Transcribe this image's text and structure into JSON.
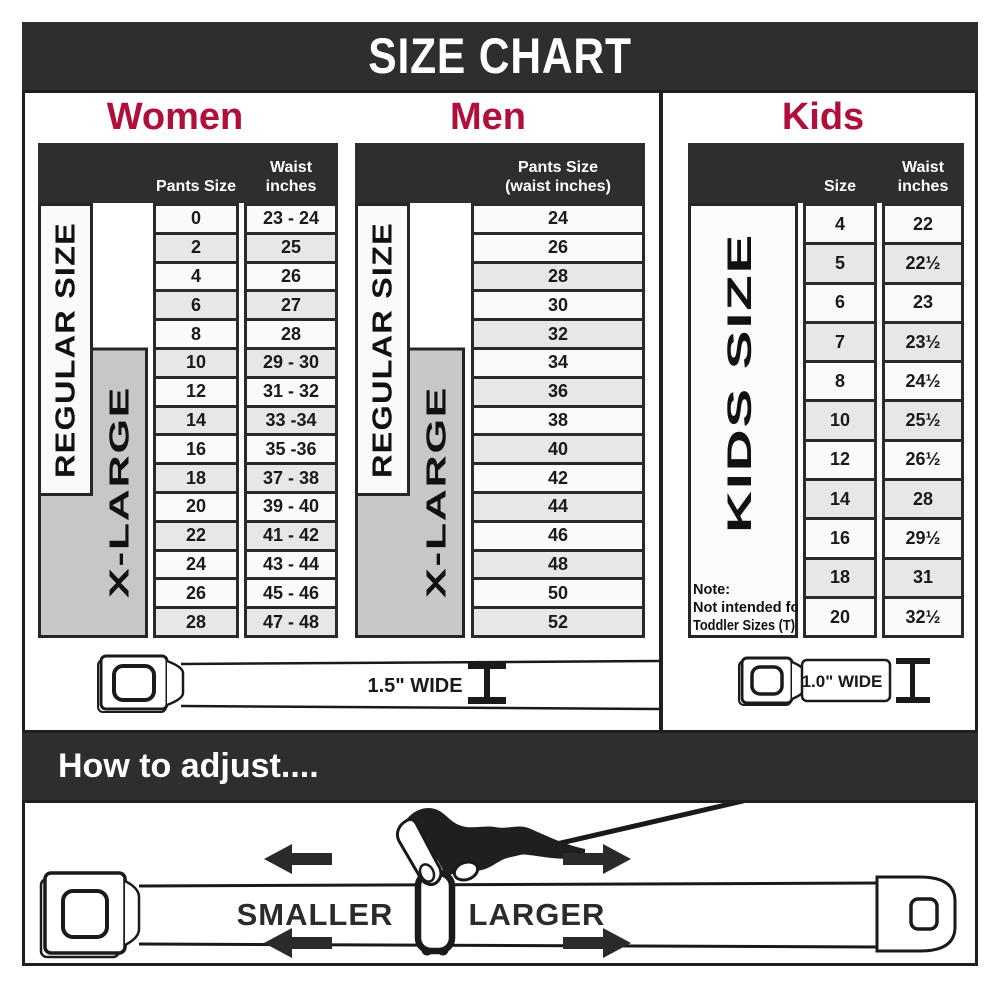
{
  "title": "SIZE CHART",
  "colors": {
    "banner_bg": "#2e2e2e",
    "border": "#1f1f1f",
    "cell_border": "#2a2a2a",
    "heading_red": "#b00f3c",
    "row_light": "#fafafa",
    "row_shade": "#e7e7e7",
    "xl_gray": "#c7c7c7"
  },
  "women": {
    "heading": "Women",
    "col1_header": "Pants Size",
    "col2_header_line1": "Waist",
    "col2_header_line2": "inches",
    "regular_label": "REGULAR SIZE",
    "xlarge_label": "X-LARGE",
    "belt_label": "1.5\" WIDE",
    "rows": [
      {
        "size": "0",
        "waist": "23 - 24",
        "shade": false
      },
      {
        "size": "2",
        "waist": "25",
        "shade": true
      },
      {
        "size": "4",
        "waist": "26",
        "shade": false
      },
      {
        "size": "6",
        "waist": "27",
        "shade": true
      },
      {
        "size": "8",
        "waist": "28",
        "shade": false
      },
      {
        "size": "10",
        "waist": "29 - 30",
        "shade": true
      },
      {
        "size": "12",
        "waist": "31 - 32",
        "shade": false
      },
      {
        "size": "14",
        "waist": "33 -34",
        "shade": true
      },
      {
        "size": "16",
        "waist": "35 -36",
        "shade": false
      },
      {
        "size": "18",
        "waist": "37 - 38",
        "shade": true
      },
      {
        "size": "20",
        "waist": "39 - 40",
        "shade": false
      },
      {
        "size": "22",
        "waist": "41 - 42",
        "shade": true
      },
      {
        "size": "24",
        "waist": "43 - 44",
        "shade": false
      },
      {
        "size": "26",
        "waist": "45 - 46",
        "shade": false
      },
      {
        "size": "28",
        "waist": "47 - 48",
        "shade": true
      }
    ]
  },
  "men": {
    "heading": "Men",
    "col_header_line1": "Pants Size",
    "col_header_line2": "(waist inches)",
    "regular_label": "REGULAR SIZE",
    "xlarge_label": "X-LARGE",
    "rows": [
      {
        "size": "24",
        "shade": false
      },
      {
        "size": "26",
        "shade": false
      },
      {
        "size": "28",
        "shade": true
      },
      {
        "size": "30",
        "shade": false
      },
      {
        "size": "32",
        "shade": true
      },
      {
        "size": "34",
        "shade": false
      },
      {
        "size": "36",
        "shade": true
      },
      {
        "size": "38",
        "shade": false
      },
      {
        "size": "40",
        "shade": true
      },
      {
        "size": "42",
        "shade": false
      },
      {
        "size": "44",
        "shade": true
      },
      {
        "size": "46",
        "shade": false
      },
      {
        "size": "48",
        "shade": true
      },
      {
        "size": "50",
        "shade": false
      },
      {
        "size": "52",
        "shade": true
      }
    ]
  },
  "kids": {
    "heading": "Kids",
    "col1_header": "Size",
    "col2_header_line1": "Waist",
    "col2_header_line2": "inches",
    "side_label": "KIDS SIZE",
    "note_line1": "Note:",
    "note_line2": "Not intended for",
    "note_line3": "Toddler Sizes (T)",
    "belt_label": "1.0\" WIDE",
    "rows": [
      {
        "size": "4",
        "waist": "22",
        "shade": false
      },
      {
        "size": "5",
        "waist": "22½",
        "shade": true
      },
      {
        "size": "6",
        "waist": "23",
        "shade": false
      },
      {
        "size": "7",
        "waist": "23½",
        "shade": true
      },
      {
        "size": "8",
        "waist": "24½",
        "shade": false
      },
      {
        "size": "10",
        "waist": "25½",
        "shade": true
      },
      {
        "size": "12",
        "waist": "26½",
        "shade": false
      },
      {
        "size": "14",
        "waist": "28",
        "shade": true
      },
      {
        "size": "16",
        "waist": "29½",
        "shade": false
      },
      {
        "size": "18",
        "waist": "31",
        "shade": true
      },
      {
        "size": "20",
        "waist": "32½",
        "shade": false
      }
    ]
  },
  "howto": {
    "heading": "How to adjust....",
    "smaller_label": "SMALLER",
    "larger_label": "LARGER"
  }
}
